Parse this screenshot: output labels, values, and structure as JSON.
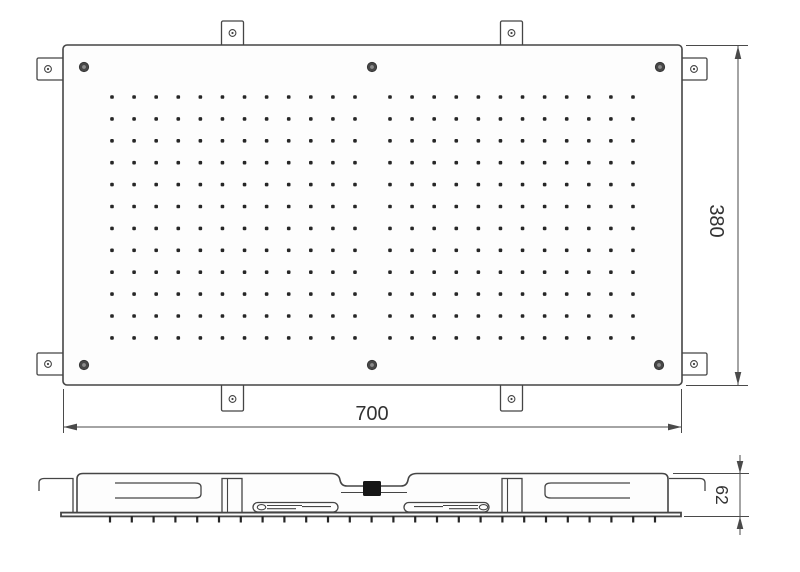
{
  "dimensions": {
    "width_mm": "700",
    "height_mm": "380",
    "depth_mm": "62"
  },
  "top_view": {
    "nozzle_grid": {
      "rows": 12,
      "cols_per_group": 12,
      "row_start_y": 97,
      "row_step": 21.9,
      "groups_start_x": [
        112,
        390
      ],
      "col_step": 22.09,
      "dot_size": 3.6
    },
    "screws": [
      [
        84,
        67
      ],
      [
        372,
        67
      ],
      [
        660,
        67
      ],
      [
        84,
        365
      ],
      [
        372,
        365
      ],
      [
        659,
        365
      ]
    ],
    "mounting_tabs": [
      {
        "x": 221.5,
        "y": 21,
        "w": 22,
        "h": 26,
        "hx": 232.5,
        "hy": 33
      },
      {
        "x": 500.5,
        "y": 21,
        "w": 22,
        "h": 26,
        "hx": 511.5,
        "hy": 33
      },
      {
        "x": 221.5,
        "y": 384,
        "w": 22,
        "h": 27,
        "hx": 232.5,
        "hy": 399
      },
      {
        "x": 500.5,
        "y": 384,
        "w": 22,
        "h": 27,
        "hx": 511.5,
        "hy": 399
      },
      {
        "x": 37,
        "y": 58,
        "w": 27,
        "h": 22,
        "hx": 48,
        "hy": 69
      },
      {
        "x": 37,
        "y": 353,
        "w": 27,
        "h": 22,
        "hx": 48,
        "hy": 364
      },
      {
        "x": 681,
        "y": 58,
        "w": 26,
        "h": 22,
        "hx": 694,
        "hy": 69
      },
      {
        "x": 681,
        "y": 353,
        "w": 26,
        "h": 22,
        "hx": 694,
        "hy": 364
      }
    ]
  },
  "side_view": {
    "nozzle_ticks": {
      "count": 26,
      "start_x": 110,
      "step": 21.8,
      "y1": 516,
      "y2": 522.5
    }
  },
  "colors": {
    "line": "#454545",
    "dot": "#262626",
    "text": "#323232",
    "background": "#ffffff"
  }
}
